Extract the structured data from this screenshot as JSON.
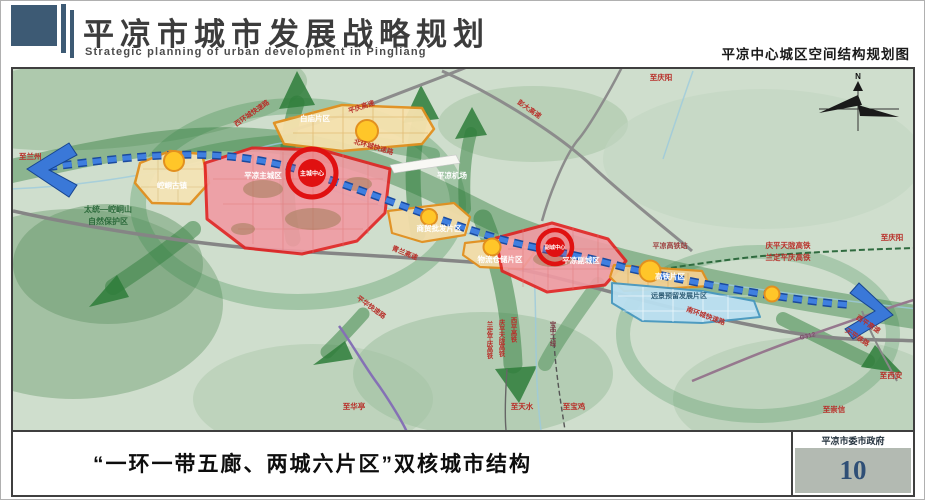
{
  "header": {
    "title_cn": "平凉市城市发展战略规划",
    "title_en": "Strategic planning of urban development in Pingliang",
    "map_title": "平凉中心城区空间结构规划图"
  },
  "footer": {
    "caption": "“一环一带五廊、两城六片区”双核城市结构",
    "org": "平凉市委市政府",
    "page": "10"
  },
  "map": {
    "labels": {
      "to_lanzhou": "至兰州",
      "nature_line1": "太统—崆峒山",
      "nature_line2": "自然保护区",
      "kongtong": "崆峒古镇",
      "west_ring": "西环城快速路",
      "baimiao": "白庙片区",
      "pingqing": "平庆高速",
      "north_ring": "北环城快速路",
      "main_city": "平凉主城区",
      "main_core": "主城中心",
      "airport": "平凉机场",
      "pengda": "彭大高速",
      "to_qingyang_n": "至庆阳",
      "qinglan": "青兰高速",
      "wholesale": "商贸批发片区",
      "logistics": "物流仓储片区",
      "sub_city": "平凉副城区",
      "sub_core": "副城中心",
      "hsr_station": "平凉高铁站",
      "hsr_area": "高铁片区",
      "reserved": "远景预留发展片区",
      "qptl": "庆平天陇高铁",
      "ldpq": "兰定平庆高铁",
      "to_qingyang_e": "至庆阳",
      "south_ring": "南环城快速路",
      "g312": "G312",
      "xiping_expwy": "西平高速",
      "tianping_rail": "天平铁路",
      "to_xian": "至西安",
      "to_chongxin": "至崇信",
      "pinghua": "平华快速路",
      "to_huating": "至华亭",
      "v_ldpq": "兰定平庆高铁",
      "v_qptl": "庆平天陇高铁",
      "v_xiping": "西平高铁",
      "v_baozhong": "宝中二线",
      "to_tianshui": "至天水",
      "to_baoji": "至宝鸡",
      "compass_n": "N"
    },
    "colors": {
      "header_blue": "#3d5a74",
      "core_red": "#e01111",
      "district_orange": "#e2901f",
      "corridor_green": "#2e7d3a",
      "transit_blue": "#3f7fe0",
      "reserved_blue": "#b9dff0",
      "page_number": "#2f4f76"
    }
  }
}
